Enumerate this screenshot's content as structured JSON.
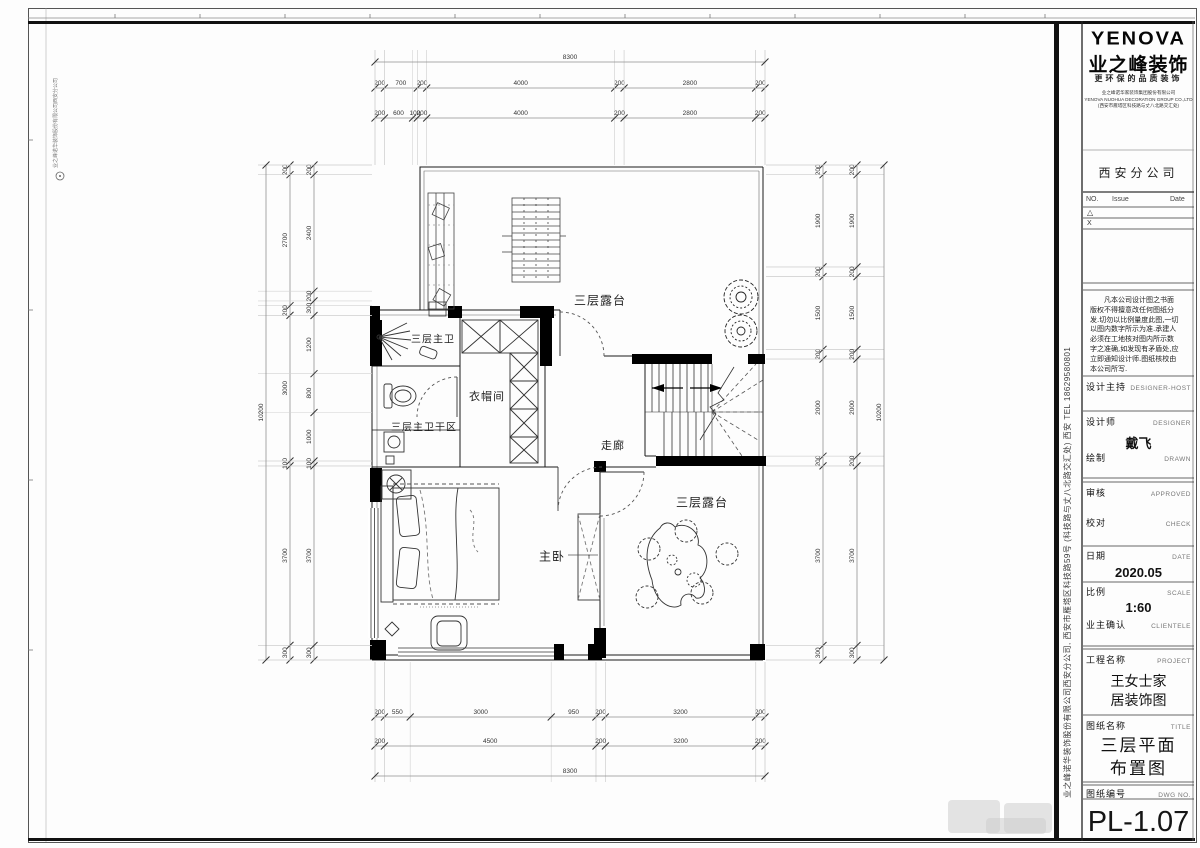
{
  "sheet": {
    "drawing_number": "PL-1.07"
  },
  "side_text": {
    "company_strip": "业之峰诺华装饰股份有限公司西安分公司, 西安市雁塔区科技路59号 (科技路与丈八北路交汇处)   西安   TEL 18629580801",
    "edge_strip": "业之峰诺华装饰股份有限公司西安分公司"
  },
  "title_block": {
    "logo": {
      "brand": "YENOVA",
      "company_cn": "业之峰装饰",
      "slogan": "更环保的品质装饰",
      "company_lines": "业之峰诺华家装饰集团股份有限公司\nYENOVA NUOHUA DECORATION GROUP CO.,LTD\n(西安市雁塔区科技路与丈八北路交汇处)",
      "branch": "西安分公司"
    },
    "revision_table": {
      "col_no": "NO.",
      "col_issue": "Issue",
      "col_date": "Date",
      "row1_mark": "△",
      "row2_mark": "X"
    },
    "disclaimer": "　　凡本公司设计图之书面\n版权不得擅意改任何图纸分\n发.切勿以比例量度此图,一切\n以图内数字所示为准.承建人\n必须在工地核对图内所示数\n字之准确,如发现有矛盾处,应\n立即通知设计师.图纸核校由\n本公司所写.",
    "fields": {
      "design_host": {
        "label": "设计主持",
        "en": "DESIGNER-HOST"
      },
      "designer": {
        "label": "设计师",
        "en": "DESIGNER"
      },
      "drawn": {
        "label": "绘制",
        "en": "DRAWN"
      },
      "approved": {
        "label": "审核",
        "en": "APPROVED"
      },
      "check": {
        "label": "校对",
        "en": "CHECK"
      },
      "date": {
        "label": "日期",
        "en": "DATE",
        "value": "2020.05"
      },
      "scale": {
        "label": "比例",
        "en": "SCALE",
        "value": "1:60"
      },
      "client": {
        "label": "业主确认",
        "en": "CLIENTELE"
      },
      "project": {
        "label": "工程名称",
        "en": "PROJECT",
        "value_lines": "王女士家\n居装饰图"
      },
      "title": {
        "label": "图纸名称",
        "en": "TITLE",
        "value_lines": "三层平面\n布置图"
      },
      "dwg_no": {
        "label": "图纸编号",
        "en": "DWG NO."
      }
    },
    "designer_name": "戴飞"
  },
  "plan": {
    "rooms": {
      "terrace_top": {
        "name": "三层露台"
      },
      "master_bath": {
        "name": "三层主卫"
      },
      "cloakroom": {
        "name": "衣帽间"
      },
      "bath_dry": {
        "name": "三层主卫干区"
      },
      "corridor": {
        "name": "走廊"
      },
      "master_bedroom": {
        "name": "主卧"
      },
      "terrace_bottom": {
        "name": "三层露台"
      }
    },
    "dimensions": {
      "top_overall": "8300",
      "bottom_overall": "8300",
      "left_overall": "10200",
      "right_overall": "10200",
      "top_row1": [
        "200",
        "700",
        "200",
        "4000",
        "200",
        "2800",
        "200"
      ],
      "top_row2": [
        "200",
        "600",
        "100",
        "200",
        "4000",
        "200",
        "2800",
        "200"
      ],
      "bottom_row1": [
        "200",
        "550",
        "3000",
        "950",
        "200",
        "3200",
        "200"
      ],
      "bottom_row2": [
        "200",
        "4500",
        "200",
        "3200",
        "200"
      ],
      "left_outer": [
        "200",
        "2700",
        "200",
        "3000",
        "100",
        "3700",
        "300"
      ],
      "left_inner": [
        "200",
        "2400",
        "200",
        "300",
        "1200",
        "800",
        "1000",
        "100",
        "3700",
        "300"
      ],
      "right_outer": [
        "200",
        "1900",
        "200",
        "1500",
        "200",
        "2000",
        "200",
        "3700",
        "300"
      ],
      "right_inner": [
        "200",
        "1900",
        "200",
        "1500",
        "200",
        "2000",
        "200",
        "3700",
        "300"
      ]
    }
  }
}
